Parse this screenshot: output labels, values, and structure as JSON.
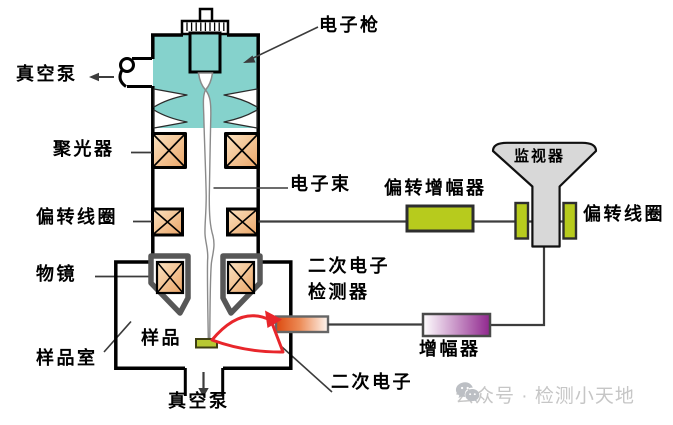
{
  "diagram": {
    "title_implicit": "扫描电子显微镜结构示意图",
    "labels": {
      "electron_gun": "电子枪",
      "vacuum_pump_top": "真空泵",
      "condenser": "聚光器",
      "electron_beam": "电子束",
      "deflection_coil": "偏转线圈",
      "objective_lens": "物镜",
      "sample": "样品",
      "sample_chamber": "样品室",
      "vacuum_pump_bottom": "真空泵",
      "deflection_amplifier": "偏转增幅器",
      "monitor": "监视器",
      "crt_deflection_coil": "偏转线圈",
      "se_detector_line1": "二次电子",
      "se_detector_line2": "检测器",
      "amplifier": "增幅器",
      "secondary_electron": "二次电子"
    },
    "colors": {
      "column_teal": "#85D2CC",
      "coil_fill_light": "#FBE3C2",
      "coil_fill_dark": "#EBA567",
      "pole_piece_gray": "#575757",
      "lens_green": "#B7CB1D",
      "sample_green": "#B8C832",
      "detector_orange": "#DC4A10",
      "amplifier_purple": "#90278E",
      "monitor_gray": "#D8D8D8",
      "beam_red": "#E8262B",
      "wire_gray": "#3D3D3D",
      "watermark_gray": "#C6C6C6"
    }
  },
  "watermark": {
    "icon": "wechat-icon",
    "text": "公众号 · 检测小天地"
  }
}
